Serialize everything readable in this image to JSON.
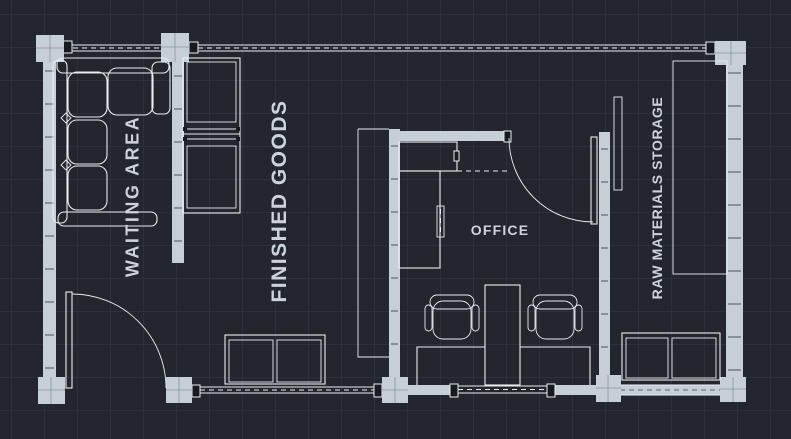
{
  "view": {
    "title": "Warehouse floor plan",
    "style": "cad-dark-canvas"
  },
  "colors": {
    "bg": "#23262d",
    "grid": "#2b313b",
    "wall": "#c6cfd6",
    "line": "#e9eef2",
    "text": "#ccd4da",
    "cap": "#171a20"
  },
  "rooms": [
    {
      "id": "waiting-area",
      "label": "WAITING AREA",
      "orientation": "vertical"
    },
    {
      "id": "finished-goods",
      "label": "FINISHED GOODS",
      "orientation": "vertical"
    },
    {
      "id": "office",
      "label": "OFFICE",
      "orientation": "horizontal"
    },
    {
      "id": "raw-materials-storage",
      "label": "RAW MATERIALS STORAGE",
      "orientation": "vertical"
    }
  ],
  "furniture": [
    {
      "id": "sectional-sofa",
      "room": "waiting-area"
    },
    {
      "id": "shelving-unit",
      "room": "finished-goods"
    },
    {
      "id": "l-shaped-counter",
      "room": "office"
    },
    {
      "id": "workstation-desks",
      "room": "office"
    },
    {
      "id": "office-chair",
      "room": "office",
      "count": 2
    },
    {
      "id": "two-door-table",
      "room": "finished-goods"
    },
    {
      "id": "two-door-table",
      "room": "raw-materials-storage"
    },
    {
      "id": "storage-rack",
      "room": "raw-materials-storage"
    }
  ],
  "openings": [
    {
      "id": "entrance-door",
      "wall": "bottom",
      "swing": "quarter-arc"
    },
    {
      "id": "office-door",
      "wall": "office-top",
      "swing": "quarter-arc"
    }
  ]
}
